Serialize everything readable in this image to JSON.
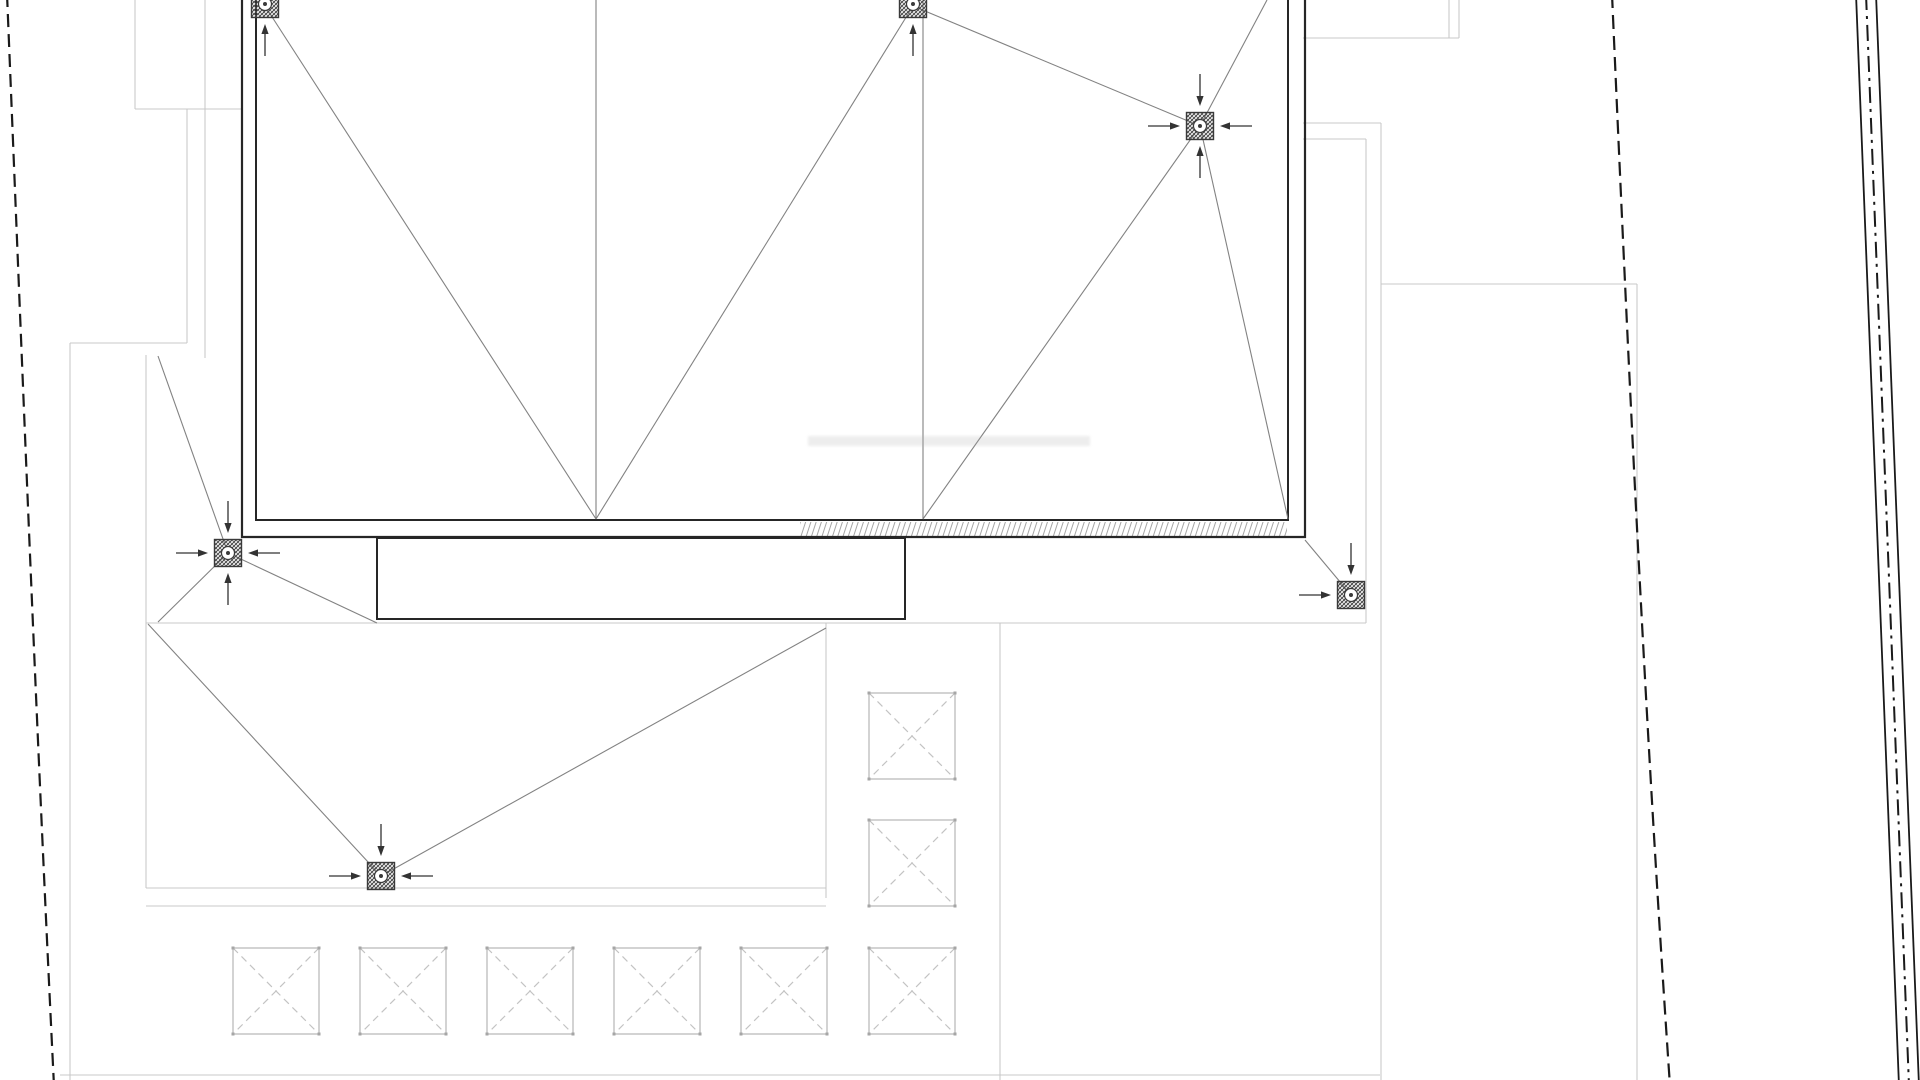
{
  "canvas": {
    "width": 1920,
    "height": 1080,
    "background": "#ffffff"
  },
  "colors": {
    "wall": "#262626",
    "roof_line": "#828282",
    "terrace_line": "#c9c9c9",
    "square_line": "#b6b6b6",
    "square_cross": "#c3c3c3",
    "square_corner": "#a6a6a6",
    "arrow": "#333333",
    "boundary": "#1a1a1a",
    "drain_stroke": "#3a3a3a",
    "wall_hatch": "#8f8f8f",
    "watermark": "#b0b0b0"
  },
  "building": {
    "outer_wall": "M242,-6 L242,537 L1305,537 L1305,-6",
    "inner_wall": "M256,-6 L256,520 L1288,520 L1288,-6",
    "wall_hatch_band": {
      "x": 800,
      "y": 522,
      "w": 487,
      "h": 14
    }
  },
  "canopy": {
    "x": 377,
    "y": 538,
    "w": 528,
    "h": 81
  },
  "roof_lines": [
    [
      596,
      0,
      596,
      519
    ],
    [
      923,
      0,
      923,
      519
    ],
    [
      265,
      6,
      596,
      519
    ],
    [
      913,
      6,
      596,
      519
    ],
    [
      913,
      6,
      1200,
      126
    ],
    [
      1267,
      0,
      1200,
      126
    ],
    [
      1200,
      126,
      923,
      519
    ],
    [
      1200,
      126,
      1288,
      519
    ],
    [
      158,
      356,
      228,
      553
    ],
    [
      228,
      553,
      158,
      622
    ],
    [
      228,
      553,
      377,
      623
    ],
    [
      1305,
      540,
      1351,
      595
    ],
    [
      148,
      624,
      381,
      876
    ],
    [
      826,
      628,
      381,
      876
    ]
  ],
  "terrace_lines": [
    [
      135,
      0,
      135,
      109
    ],
    [
      135,
      109,
      242,
      109
    ],
    [
      187,
      109,
      187,
      343
    ],
    [
      205,
      0,
      205,
      358
    ],
    [
      70,
      343,
      187,
      343
    ],
    [
      70,
      343,
      70,
      1080
    ],
    [
      146,
      355,
      146,
      888
    ],
    [
      146,
      623,
      1366,
      623
    ],
    [
      146,
      888,
      826,
      888
    ],
    [
      146,
      906,
      826,
      906
    ],
    [
      826,
      623,
      826,
      898
    ],
    [
      1000,
      623,
      1000,
      1080
    ],
    [
      1366,
      139,
      1366,
      623
    ],
    [
      1381,
      123,
      1381,
      1080
    ],
    [
      1303,
      123,
      1381,
      123
    ],
    [
      1303,
      139,
      1366,
      139
    ],
    [
      1381,
      284,
      1637,
      284
    ],
    [
      1637,
      284,
      1637,
      1080
    ],
    [
      1303,
      38,
      1459,
      38
    ],
    [
      1449,
      0,
      1449,
      38
    ],
    [
      1459,
      0,
      1459,
      38
    ],
    [
      60,
      1075,
      1380,
      1075
    ]
  ],
  "drains": [
    {
      "x": 265,
      "y": 4,
      "arrows": [
        "bottom"
      ]
    },
    {
      "x": 913,
      "y": 4,
      "arrows": [
        "bottom"
      ]
    },
    {
      "x": 1200,
      "y": 126,
      "arrows": [
        "top",
        "bottom",
        "left",
        "right"
      ]
    },
    {
      "x": 228,
      "y": 553,
      "arrows": [
        "top",
        "bottom",
        "left",
        "right"
      ]
    },
    {
      "x": 1351,
      "y": 595,
      "arrows": [
        "top",
        "left"
      ]
    },
    {
      "x": 381,
      "y": 876,
      "arrows": [
        "top",
        "left",
        "right"
      ]
    }
  ],
  "drain_style": {
    "size": 27,
    "ring_radius": 6.5,
    "dot_radius": 2
  },
  "arrow_style": {
    "gap": 20,
    "head": 10,
    "shaft": 22,
    "half_width": 3.6
  },
  "crossed_squares": {
    "size": 86,
    "positions": [
      [
        233,
        948
      ],
      [
        360,
        948
      ],
      [
        487,
        948
      ],
      [
        614,
        948
      ],
      [
        741,
        948
      ],
      [
        869,
        948
      ],
      [
        869,
        693
      ],
      [
        869,
        820
      ]
    ]
  },
  "boundaries": {
    "left_dashed": {
      "d": "M7,-6 C22,360 36,720 54,1086",
      "dash": "13 7",
      "width": 2.2
    },
    "inner_dashed": {
      "d": "M1612,-6 C1628,360 1645,720 1670,1086",
      "dash": "14 7",
      "width": 2.2
    },
    "right_triple": [
      {
        "d": "M1856,-6 L1899,1086",
        "dash": "",
        "width": 1.8
      },
      {
        "d": "M1866,-6 L1909,1086",
        "dash": "16 6 3 6",
        "width": 2.0
      },
      {
        "d": "M1876,-6 L1919,1086",
        "dash": "",
        "width": 1.8
      }
    ]
  },
  "watermark": {
    "x": 808,
    "y": 436,
    "w": 282,
    "h": 10
  }
}
